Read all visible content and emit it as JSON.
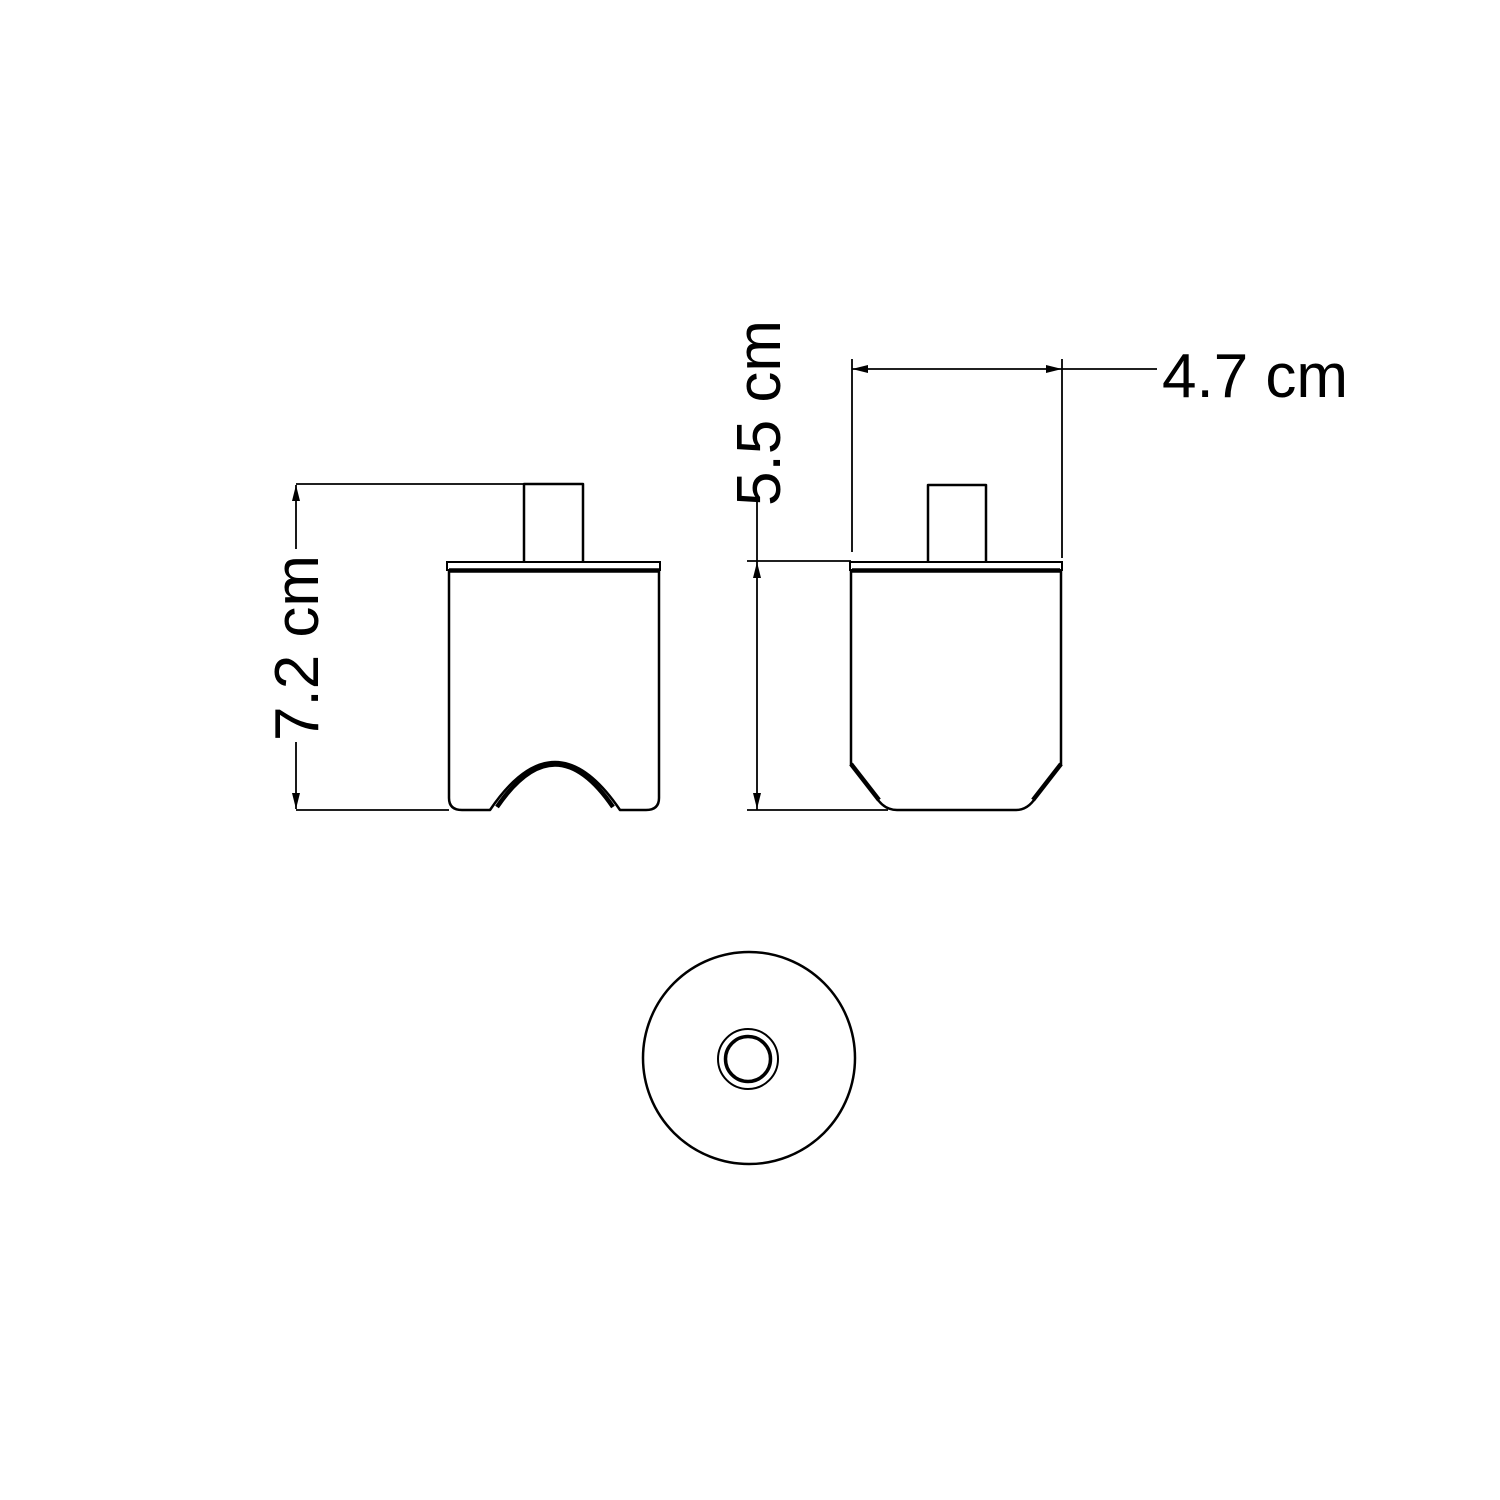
{
  "page": {
    "background_color": "#ffffff",
    "line_color": "#000000",
    "description": "Technical dimension drawing with three orthographic views of a ceiling-rose / lamp socket cover"
  },
  "views": {
    "front": {
      "name": "front view with cable arch cutout"
    },
    "side": {
      "name": "side view with chamfered bottom corners"
    },
    "bottom": {
      "name": "bottom view with concentric cable hole"
    }
  },
  "dimensions": {
    "front_height": {
      "label": "7.2 cm",
      "value": 7.2,
      "unit": "cm",
      "orientation": "vertical"
    },
    "side_height": {
      "label": "5.5 cm",
      "value": 5.5,
      "unit": "cm",
      "orientation": "vertical"
    },
    "side_width": {
      "label": "4.7 cm",
      "value": 4.7,
      "unit": "cm",
      "orientation": "horizontal"
    }
  }
}
